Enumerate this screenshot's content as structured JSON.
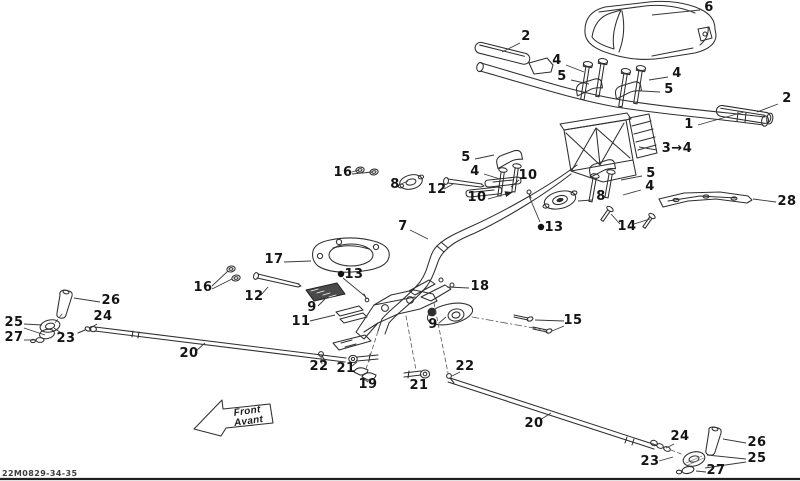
{
  "meta": {
    "drawing_code": "22M0829-34-35",
    "background": "#ffffff",
    "line_color": "#2e2e2e",
    "label_color": "#141414"
  },
  "direction_arrow": {
    "line1": "Front",
    "line2": "Avant"
  },
  "callouts": [
    {
      "label": "6",
      "x": 709,
      "y": 11,
      "leaders": [
        [
          700,
          10,
          652,
          15
        ]
      ]
    },
    {
      "label": "2",
      "x": 526,
      "y": 40,
      "leaders": [
        [
          520,
          43,
          502,
          52
        ]
      ]
    },
    {
      "label": "4",
      "x": 557,
      "y": 64,
      "leaders": [
        [
          566,
          65,
          584,
          72
        ]
      ]
    },
    {
      "label": "5",
      "x": 562,
      "y": 80,
      "leaders": [
        [
          571,
          80,
          589,
          84
        ]
      ]
    },
    {
      "label": "4",
      "x": 677,
      "y": 77,
      "leaders": [
        [
          668,
          77,
          649,
          80
        ]
      ]
    },
    {
      "label": "5",
      "x": 669,
      "y": 93,
      "leaders": [
        [
          660,
          92,
          642,
          91
        ]
      ]
    },
    {
      "label": "2",
      "x": 787,
      "y": 102,
      "leaders": [
        [
          778,
          104,
          757,
          112
        ]
      ]
    },
    {
      "label": "1",
      "x": 689,
      "y": 128,
      "leaders": [
        [
          698,
          125,
          744,
          112
        ]
      ]
    },
    {
      "label": "3→4",
      "x": 677,
      "y": 152,
      "leaders": [
        [
          657,
          150,
          639,
          147
        ]
      ]
    },
    {
      "label": "5",
      "x": 651,
      "y": 177,
      "leaders": [
        [
          642,
          176,
          621,
          180
        ]
      ]
    },
    {
      "label": "4",
      "x": 650,
      "y": 190,
      "leaders": [
        [
          641,
          190,
          623,
          195
        ]
      ]
    },
    {
      "label": "5",
      "x": 466,
      "y": 161,
      "leaders": [
        [
          475,
          159,
          494,
          155
        ]
      ]
    },
    {
      "label": "4",
      "x": 475,
      "y": 175,
      "leaders": [
        [
          484,
          174,
          500,
          179
        ]
      ]
    },
    {
      "label": "10",
      "x": 528,
      "y": 179,
      "leaders": [
        [
          519,
          180,
          511,
          187
        ]
      ]
    },
    {
      "label": "10",
      "x": 477,
      "y": 201,
      "leaders": [
        [
          488,
          199,
          513,
          192,
          "a"
        ]
      ]
    },
    {
      "label": "12",
      "x": 437,
      "y": 193,
      "leaders": [
        [
          444,
          189,
          453,
          184
        ]
      ]
    },
    {
      "label": "8",
      "x": 395,
      "y": 188,
      "leaders": [
        [
          401,
          184,
          408,
          181
        ]
      ]
    },
    {
      "label": "16",
      "x": 343,
      "y": 176,
      "leaders": [
        [
          352,
          172,
          359,
          170
        ],
        [
          352,
          174,
          372,
          172
        ]
      ]
    },
    {
      "label": "7",
      "x": 403,
      "y": 230,
      "leaders": [
        [
          410,
          230,
          428,
          239
        ]
      ]
    },
    {
      "label": "13",
      "x": 554,
      "y": 231,
      "dot": [
        541,
        227
      ],
      "leaders": [
        [
          540,
          222,
          529,
          196
        ]
      ]
    },
    {
      "label": "8",
      "x": 601,
      "y": 200,
      "leaders": [
        [
          592,
          200,
          578,
          201
        ]
      ]
    },
    {
      "label": "14",
      "x": 627,
      "y": 230,
      "leaders": [
        [
          620,
          224,
          611,
          214
        ],
        [
          634,
          224,
          650,
          219
        ]
      ]
    },
    {
      "label": "28",
      "x": 787,
      "y": 205,
      "leaders": [
        [
          776,
          202,
          753,
          199
        ]
      ]
    },
    {
      "label": "17",
      "x": 274,
      "y": 263,
      "leaders": [
        [
          284,
          262,
          311,
          261
        ]
      ]
    },
    {
      "label": "13",
      "x": 354,
      "y": 278,
      "dot": [
        341,
        274
      ],
      "leaders": [
        [
          343,
          278,
          366,
          297
        ]
      ]
    },
    {
      "label": "16",
      "x": 203,
      "y": 291,
      "leaders": [
        [
          212,
          286,
          228,
          271
        ],
        [
          212,
          289,
          232,
          279
        ]
      ]
    },
    {
      "label": "12",
      "x": 254,
      "y": 300,
      "leaders": [
        [
          261,
          295,
          268,
          287
        ]
      ]
    },
    {
      "label": "9",
      "x": 312,
      "y": 311,
      "leaders": [
        [
          318,
          306,
          325,
          299
        ]
      ]
    },
    {
      "label": "11",
      "x": 301,
      "y": 325,
      "leaders": [
        [
          310,
          321,
          335,
          315
        ]
      ]
    },
    {
      "label": "18",
      "x": 480,
      "y": 290,
      "leaders": [
        [
          469,
          288,
          447,
          287
        ]
      ]
    },
    {
      "label": "9",
      "x": 433,
      "y": 328,
      "leaders": [
        [
          439,
          323,
          446,
          317
        ]
      ]
    },
    {
      "label": "15",
      "x": 573,
      "y": 324,
      "leaders": [
        [
          564,
          321,
          535,
          320
        ],
        [
          564,
          326,
          552,
          331
        ]
      ]
    },
    {
      "label": "26",
      "x": 111,
      "y": 304,
      "leaders": [
        [
          100,
          302,
          74,
          298
        ]
      ]
    },
    {
      "label": "24",
      "x": 103,
      "y": 320,
      "leaders": [
        [
          97,
          324,
          89,
          329
        ]
      ]
    },
    {
      "label": "25",
      "x": 14,
      "y": 326,
      "leaders": [
        [
          24,
          324,
          42,
          325
        ],
        [
          24,
          328,
          45,
          335
        ]
      ]
    },
    {
      "label": "27",
      "x": 14,
      "y": 341,
      "leaders": [
        [
          24,
          340,
          36,
          340
        ]
      ]
    },
    {
      "label": "23",
      "x": 66,
      "y": 342,
      "leaders": [
        [
          64,
          335,
          54,
          328
        ]
      ]
    },
    {
      "label": "20",
      "x": 189,
      "y": 357,
      "leaders": [
        [
          196,
          351,
          205,
          343
        ]
      ]
    },
    {
      "label": "22",
      "x": 319,
      "y": 370,
      "leaders": [
        [
          322,
          364,
          321,
          357
        ]
      ]
    },
    {
      "label": "21",
      "x": 346,
      "y": 372,
      "leaders": [
        [
          352,
          366,
          357,
          362
        ]
      ]
    },
    {
      "label": "19",
      "x": 368,
      "y": 388,
      "leaders": [
        [
          368,
          382,
          364,
          379
        ]
      ]
    },
    {
      "label": "21",
      "x": 419,
      "y": 389,
      "leaders": [
        [
          424,
          383,
          422,
          379
        ]
      ]
    },
    {
      "label": "22",
      "x": 465,
      "y": 370,
      "leaders": [
        [
          460,
          372,
          452,
          376
        ]
      ]
    },
    {
      "label": "20",
      "x": 534,
      "y": 427,
      "leaders": [
        [
          540,
          420,
          551,
          413
        ]
      ]
    },
    {
      "label": "24",
      "x": 680,
      "y": 440,
      "leaders": [
        [
          674,
          444,
          666,
          448
        ]
      ]
    },
    {
      "label": "26",
      "x": 757,
      "y": 446,
      "leaders": [
        [
          746,
          443,
          723,
          439
        ]
      ]
    },
    {
      "label": "25",
      "x": 757,
      "y": 462,
      "leaders": [
        [
          746,
          459,
          707,
          455
        ],
        [
          746,
          462,
          705,
          468
        ]
      ]
    },
    {
      "label": "23",
      "x": 650,
      "y": 465,
      "leaders": [
        [
          659,
          461,
          673,
          457
        ]
      ]
    },
    {
      "label": "27",
      "x": 716,
      "y": 474,
      "leaders": [
        [
          706,
          472,
          696,
          471
        ]
      ]
    }
  ]
}
